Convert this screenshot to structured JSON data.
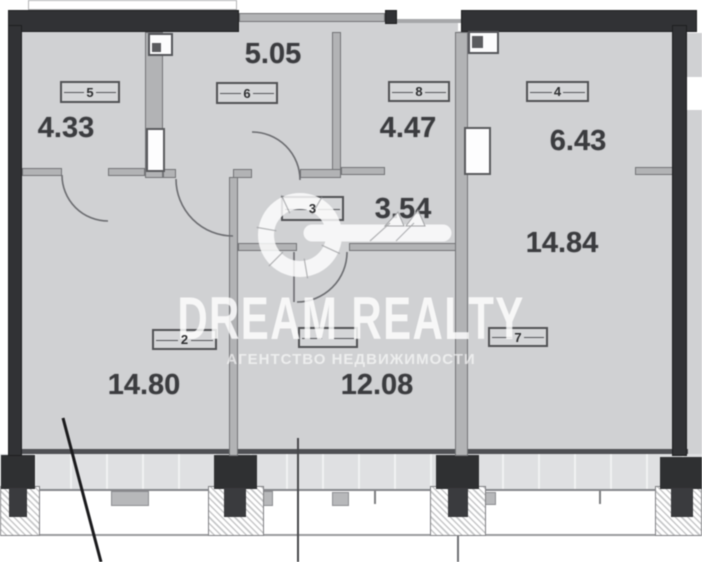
{
  "plan": {
    "watermark": {
      "title": "DREAM REALTY",
      "subtitle": "АГЕНТСТВО НЕДВИЖИМОСТИ"
    },
    "rooms": [
      {
        "number": "5",
        "area": "4.33"
      },
      {
        "number": "6",
        "area": "5.05"
      },
      {
        "number": "8",
        "area": "4.47"
      },
      {
        "number": "4",
        "area": "6.43"
      },
      {
        "number": "3",
        "area": "3.54"
      },
      {
        "number": "2",
        "area": "14.80"
      },
      {
        "number": "",
        "area": "12.08"
      },
      {
        "number": "7",
        "area": "14.84"
      }
    ],
    "colors": {
      "floor": "#d0d1d3",
      "wall-dark": "#313235",
      "wall-inner": "#b2b3b5",
      "wall-edge": "#737477",
      "band": "#dfe0e2",
      "text": "#3b3c3f",
      "line": "#6b6c70"
    }
  }
}
